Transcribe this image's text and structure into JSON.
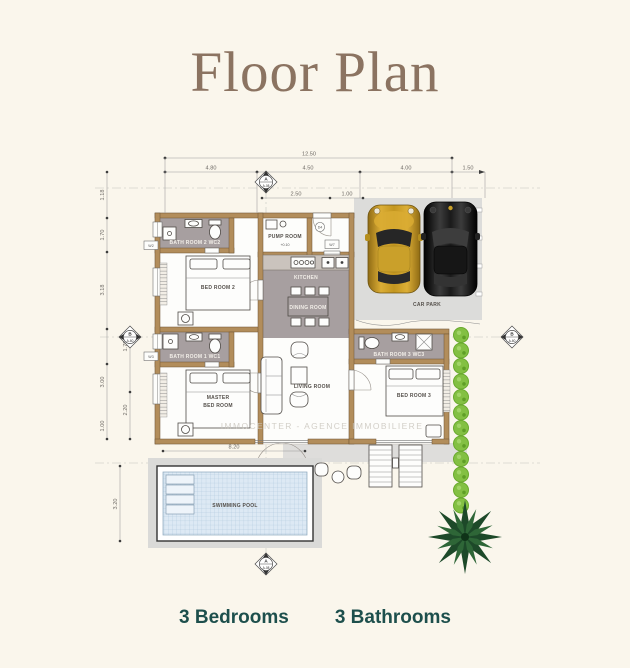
{
  "title": "Floor Plan",
  "footer": {
    "bedrooms": "3 Bedrooms",
    "bathrooms": "3 Bathrooms"
  },
  "plan": {
    "rooms": {
      "bath2": "BATH ROOM 2 WC2",
      "bed2": "BED ROOM 2",
      "pump": "PUMP ROOM",
      "kitchen": "KITCHEN",
      "dining": "DINING ROOM",
      "carpark": "CAR PARK",
      "bath1": "BATH ROOM 1 WC1",
      "master_line1": "MASTER",
      "master_line2": "BED ROOM",
      "living": "LIVING ROOM",
      "bath3": "BATH ROOM 3 WC3",
      "bed3": "BED ROOM 3",
      "pool": "SWIMMING POOL"
    },
    "dims": {
      "total": "12.50",
      "top": [
        "4.80",
        "4.50",
        "4.00",
        "1.50"
      ],
      "pump": [
        "2.50",
        "1.00"
      ],
      "left": [
        "1.18",
        "1.70",
        "3.18",
        "1.70",
        "3.00",
        "2.20",
        "1.00"
      ],
      "pool_width": "8.20",
      "pool_height": "3.20"
    },
    "markers": {
      "a": "A",
      "a_sheet": "A-08",
      "b": "B",
      "b_sheet": "A-60"
    },
    "tags": {
      "w2": "W2",
      "w3": "W3",
      "w7": "W7",
      "d4": "D4",
      "level": "+0.10"
    },
    "watermark": "IMMOCENTER - AGENCE IMMOBILIERE"
  },
  "colors": {
    "background": "#faf6ec",
    "title": "#8b7361",
    "footer_text": "#1d4f4c",
    "wall": "#b28d5b",
    "floor_gray": "#a79fa0",
    "carpark": "#dcdcda",
    "pool_water": "#dde9f4",
    "hedge": "#83c043",
    "palm": "#1d4929",
    "car_gold": "#c3961f",
    "car_black": "#1b1b1b"
  }
}
